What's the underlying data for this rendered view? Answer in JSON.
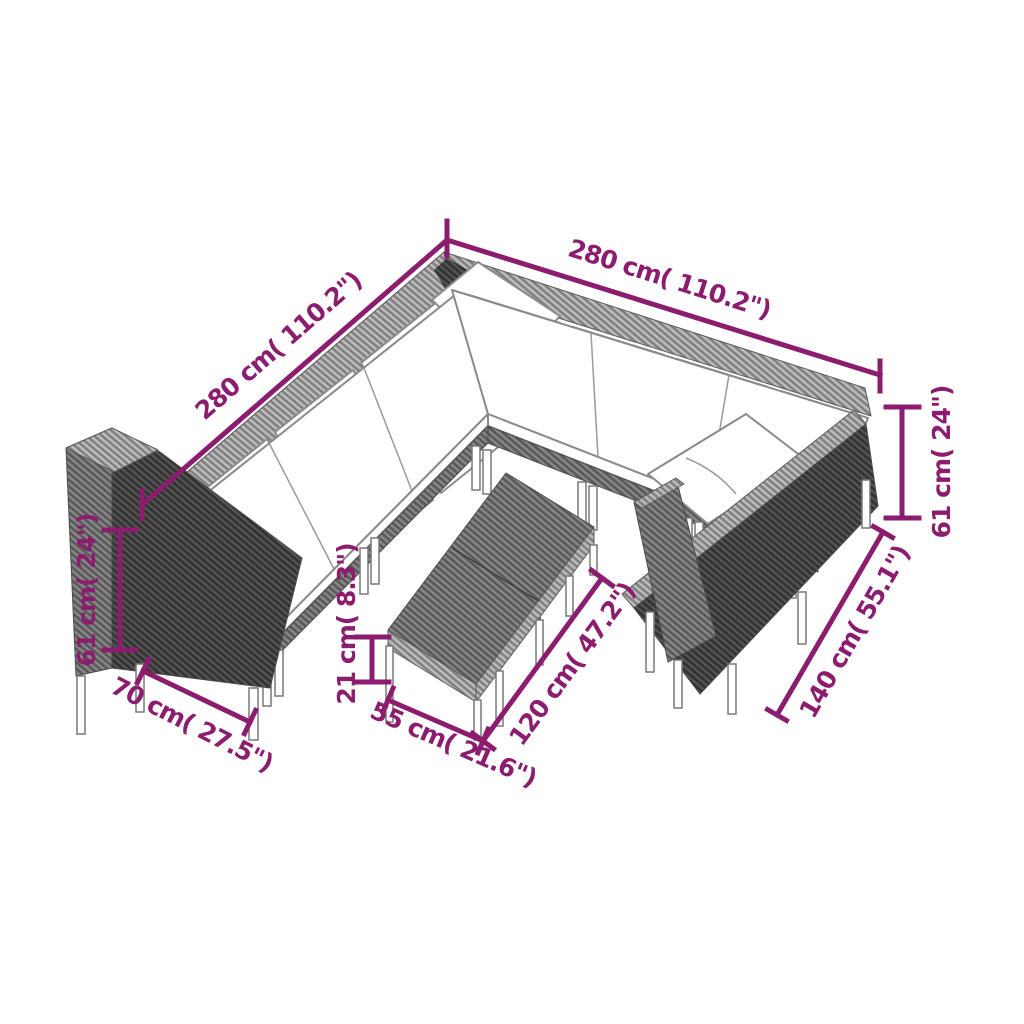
{
  "illustration": {
    "subject": "isometric line drawing of an L-shaped poly-rattan garden lounge set with corner sofas, white cushions and a two-piece coffee-table bench"
  },
  "colors": {
    "dimension_accent": "#8B1C6E",
    "rattan_dark": "#3F3F3F",
    "rattan_mid": "#6D6D6D",
    "rattan_light": "#9A9A9A",
    "cushion": "#FFFFFF",
    "outline_gray": "#787878",
    "background": "#FFFFFF"
  },
  "dimensions": {
    "right_wing_length": {
      "label": "280 cm( 110.2\")",
      "cm": 280,
      "inches": 110.2
    },
    "left_wing_length": {
      "label": "280 cm( 110.2\")",
      "cm": 280,
      "inches": 110.2
    },
    "right_height": {
      "label": "61 cm( 24\")",
      "cm": 61,
      "inches": 24
    },
    "right_depth": {
      "label": "140 cm( 55.1\")",
      "cm": 140,
      "inches": 55.1
    },
    "left_height": {
      "label": "61 cm( 24\")",
      "cm": 61,
      "inches": 24
    },
    "left_depth": {
      "label": "70 cm( 27.5\")",
      "cm": 70,
      "inches": 27.5
    },
    "table_height": {
      "label": "21 cm( 8.3\")",
      "cm": 21,
      "inches": 8.3
    },
    "table_width": {
      "label": "55 cm( 21.6\")",
      "cm": 55,
      "inches": 21.6
    },
    "table_length": {
      "label": "120 cm( 47.2\")",
      "cm": 120,
      "inches": 47.2
    }
  }
}
